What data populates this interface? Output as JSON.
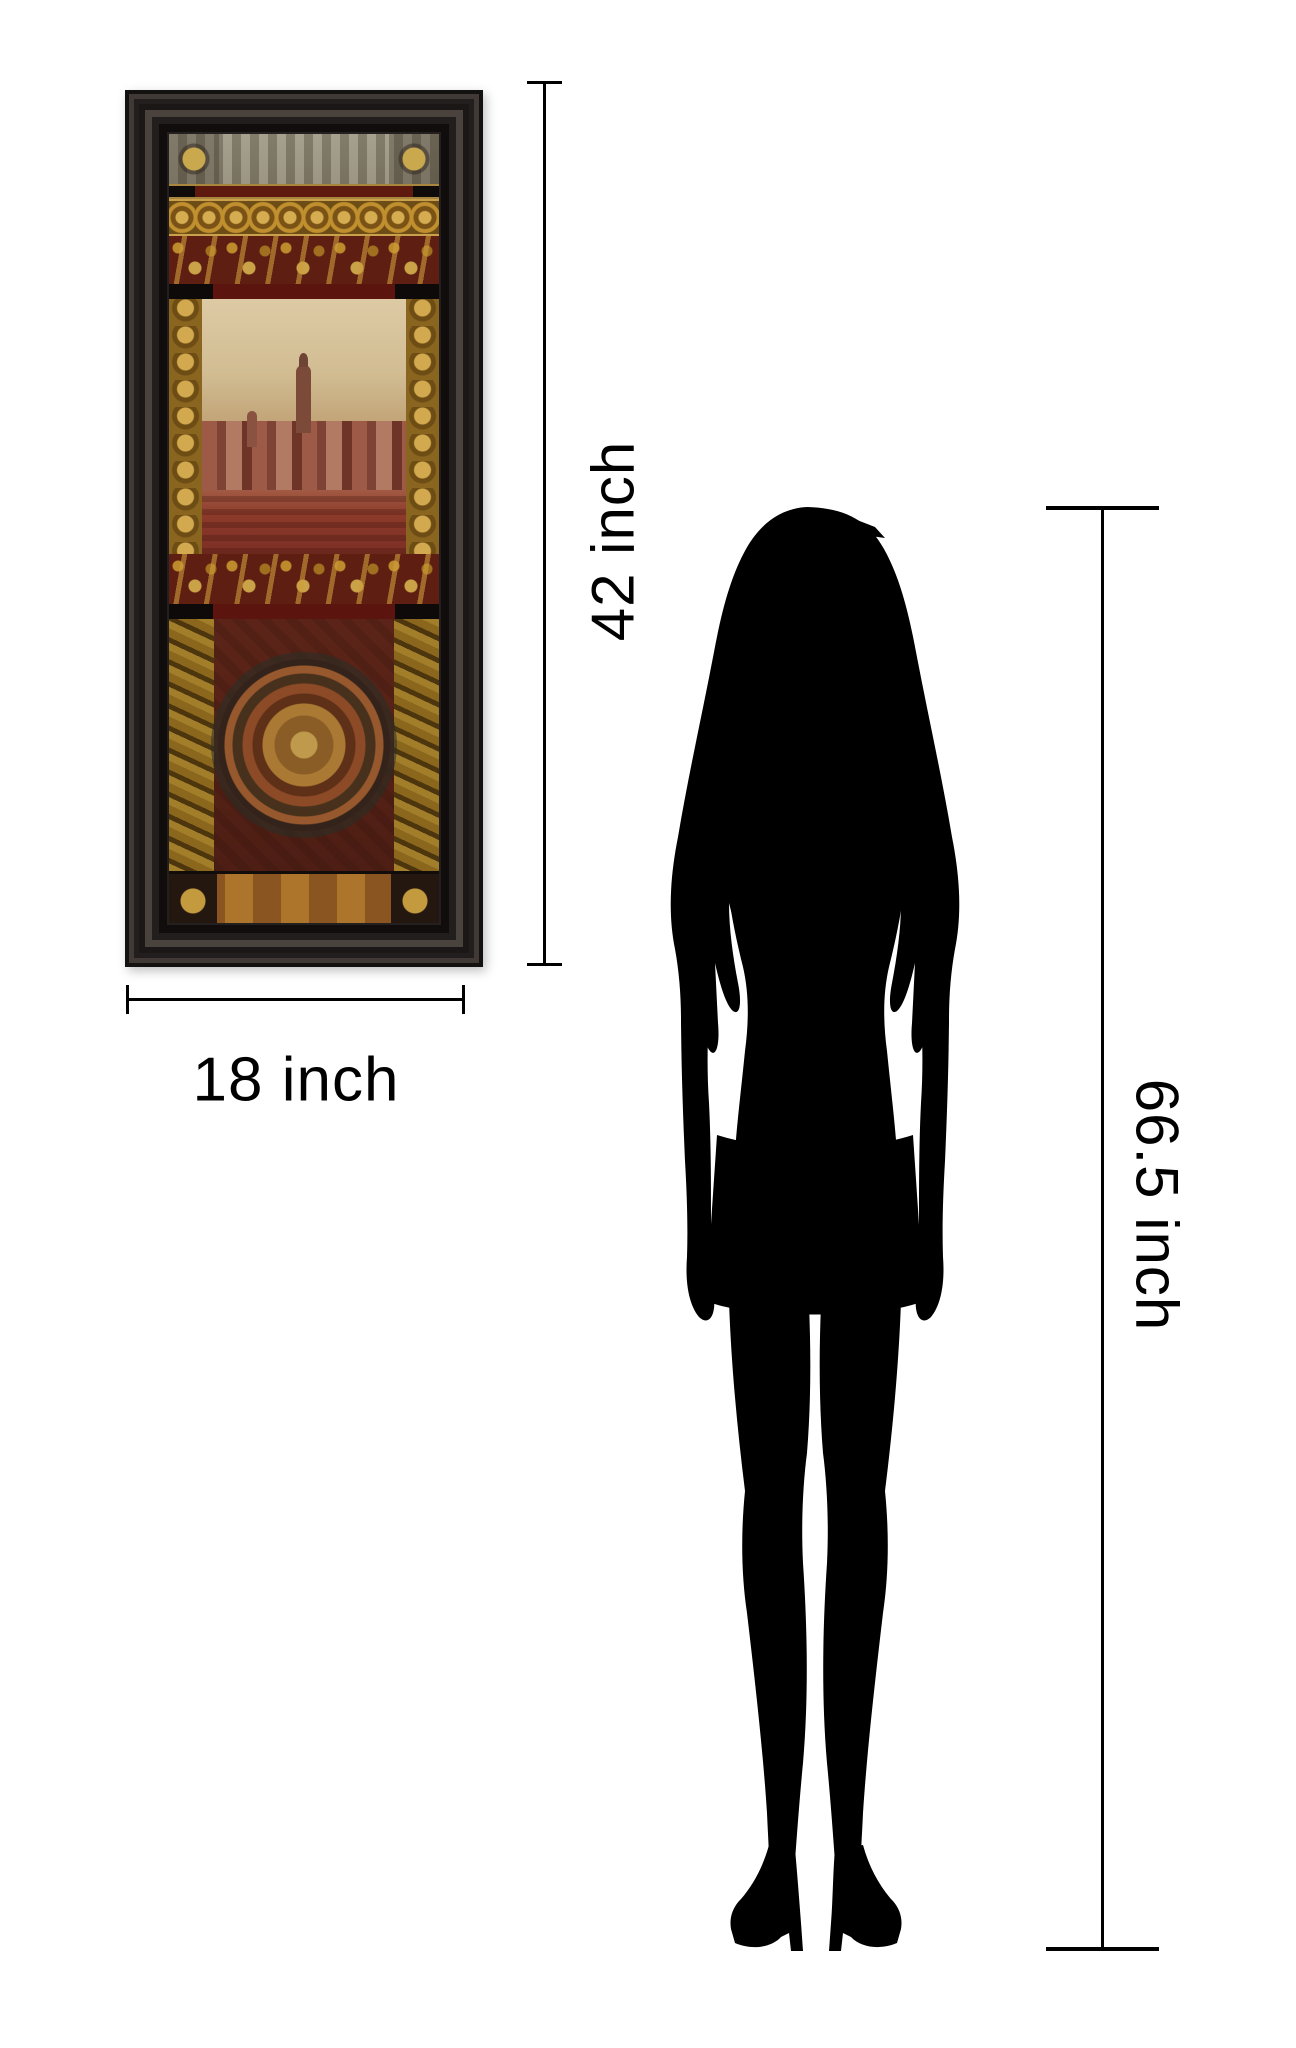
{
  "diagram": {
    "type": "product-size-comparison",
    "background_color": "#ffffff",
    "measure_line_color": "#000000"
  },
  "artwork": {
    "name": "ornate framed art print with cityscape and medallion",
    "height_label": "42 inch",
    "width_label": "18 inch",
    "frame_color": "#242020",
    "palette": {
      "gold": "#b5842c",
      "dark_gold": "#7a5518",
      "maroon": "#5f1d12",
      "parchment": "#d9c7a0",
      "silver_band": "#97907c",
      "city_rose": "#9c5a47",
      "medallion_red": "#5c2418"
    }
  },
  "person": {
    "name": "woman silhouette",
    "height_label": "66.5 inch",
    "silhouette_color": "#000000"
  }
}
